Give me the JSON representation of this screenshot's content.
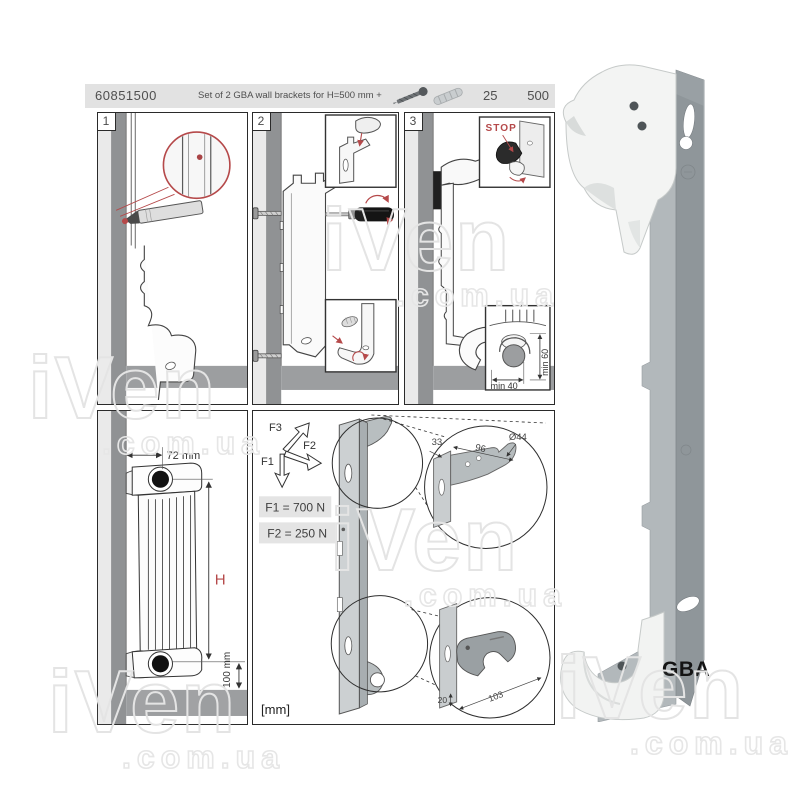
{
  "header": {
    "sku": "60851500",
    "description": "Set of 2 GBA wall brackets for H=500 mm +",
    "pack_qty": "25",
    "height_code": "500"
  },
  "steps": {
    "one": "1",
    "two": "2",
    "three": "3"
  },
  "step3": {
    "stop": "STOP",
    "min_40": "min 40",
    "min_60": "min 60"
  },
  "dims": {
    "depth": "72 mm",
    "height": "H",
    "clearance": "100 mm"
  },
  "forces": {
    "f1": "F1",
    "f2": "F2",
    "f3": "F3",
    "f1_value": "F1 = 700 N",
    "f2_value": "F2 = 250 N"
  },
  "bracket_dims": {
    "top_depth": "33",
    "top_length": "96",
    "hook_dia": "Ø44",
    "bottom_offset": "20",
    "bottom_length": "103",
    "units": "[mm]"
  },
  "product": {
    "name": "GBA"
  },
  "watermark": {
    "word": "iVen",
    "domain": ".com.ua"
  },
  "colors": {
    "accent_red": "#b5494a",
    "header_bg": "#e2e2e2",
    "wall_dark": "#909294",
    "wall_light": "#eaeaea",
    "floor": "#9c9ea0",
    "metal": "#c9cdcf",
    "metal_dark": "#8f969a"
  }
}
